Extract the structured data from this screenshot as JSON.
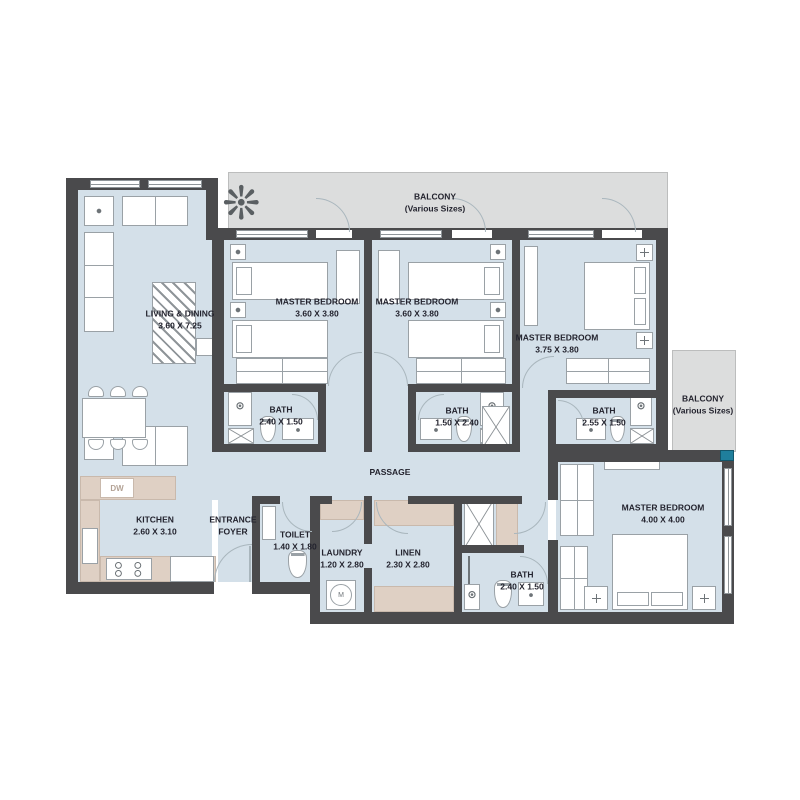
{
  "colors": {
    "wall": "#4a4a4c",
    "floor": "#d4e0e9",
    "balcony": "#dcdddd",
    "beige": "#dfd0c4",
    "line": "#9aa1a6",
    "text": "#23232e",
    "teal": "#1f7f9c"
  },
  "rooms": {
    "balcony_top": {
      "name": "BALCONY",
      "note": "(Various Sizes)"
    },
    "balcony_right": {
      "name": "BALCONY",
      "note": "(Various Sizes)"
    },
    "living_dining": {
      "name": "LIVING & DINING",
      "dims": "3.60 X 7.25"
    },
    "master_bedroom_1": {
      "name": "MASTER BEDROOM",
      "dims": "3.60 X 3.80"
    },
    "master_bedroom_2": {
      "name": "MASTER BEDROOM",
      "dims": "3.60 X 3.80"
    },
    "master_bedroom_3": {
      "name": "MASTER BEDROOM",
      "dims": "3.75 X 3.80"
    },
    "master_bedroom_4": {
      "name": "MASTER BEDROOM",
      "dims": "4.00 X 4.00"
    },
    "bath_1": {
      "name": "BATH",
      "dims": "2.40 X 1.50"
    },
    "bath_2": {
      "name": "BATH",
      "dims": "1.50 X 2.40"
    },
    "bath_3": {
      "name": "BATH",
      "dims": "2.55 X 1.50"
    },
    "bath_4": {
      "name": "BATH",
      "dims": "2.40 X 1.50"
    },
    "kitchen": {
      "name": "KITCHEN",
      "dims": "2.60 X 3.10"
    },
    "entrance_foyer": {
      "name_line1": "ENTRANCE",
      "name_line2": "FOYER"
    },
    "toilet": {
      "name": "TOILET",
      "dims": "1.40 X 1.80"
    },
    "laundry": {
      "name": "LAUNDRY",
      "dims": "1.20 X 2.80"
    },
    "linen": {
      "name": "LINEN",
      "dims": "2.30 X 2.80"
    },
    "passage": {
      "name": "PASSAGE"
    }
  },
  "appliances": {
    "dishwasher_label": "DW",
    "washer_label": "M"
  },
  "decor": {
    "plant_glyph": "❊"
  }
}
